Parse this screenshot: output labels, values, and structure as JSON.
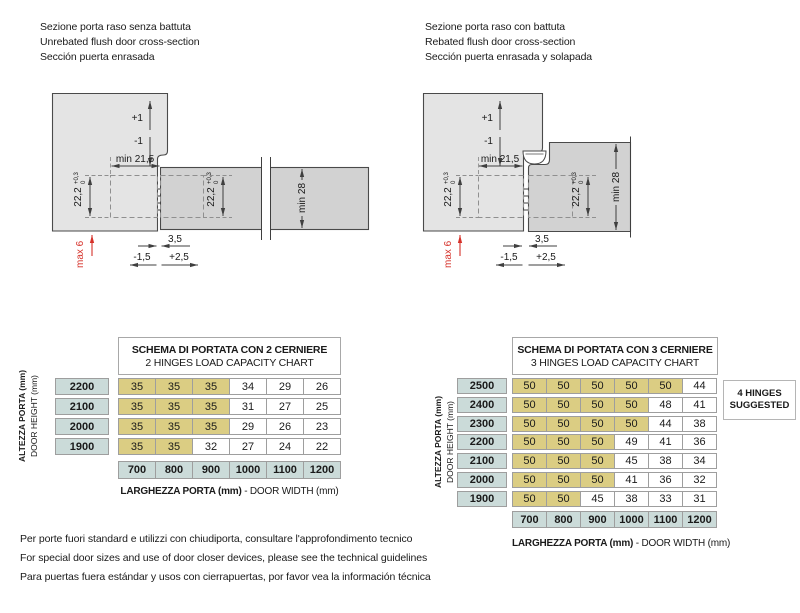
{
  "colors": {
    "highlight_yellow": "#dbcd83",
    "axis_teal": "#cbdbd9",
    "frame_gray": "#e4e4e4",
    "door_gray": "#d2d2d2",
    "accent_red": "#d63129"
  },
  "headers": {
    "left": {
      "lines": [
        "Sezione porta raso senza battuta",
        "Unrebated flush door cross-section",
        "Sección puerta enrasada"
      ]
    },
    "right": {
      "lines": [
        "Sezione porta raso con battuta",
        "Rebated flush door cross-section",
        "Sección puerta enrasada y solapada"
      ]
    }
  },
  "diagram_labels": {
    "adjust_up": "+1",
    "adjust_down": "-1",
    "min_reveal": "min 21,5",
    "hinge_cup": "22,2",
    "tol_plus": "+0,3",
    "tol_zero": "0",
    "min_door_thickness": "min 28",
    "gap": "3,5",
    "adjust_neg": "-1,5",
    "adjust_pos": "+2,5",
    "max_offset": "max 6"
  },
  "tables": {
    "left": {
      "title_line1": "SCHEMA DI PORTATA CON 2 CERNIERE",
      "title_line2": "2 HINGES LOAD CAPACITY CHART",
      "y_axis_bold": "ALTEZZA PORTA (mm)",
      "y_axis_regular": "DOOR HEIGHT (mm)",
      "x_axis_bold": "LARGHEZZA PORTA (mm)",
      "x_axis_regular": "- DOOR WIDTH (mm)",
      "columns": [
        "700",
        "800",
        "900",
        "1000",
        "1100",
        "1200"
      ],
      "rows": [
        {
          "height": "2200",
          "values": [
            "35",
            "35",
            "35",
            "34",
            "29",
            "26"
          ],
          "highlighted": 3
        },
        {
          "height": "2100",
          "values": [
            "35",
            "35",
            "35",
            "31",
            "27",
            "25"
          ],
          "highlighted": 3
        },
        {
          "height": "2000",
          "values": [
            "35",
            "35",
            "35",
            "29",
            "26",
            "23"
          ],
          "highlighted": 3
        },
        {
          "height": "1900",
          "values": [
            "35",
            "35",
            "32",
            "27",
            "24",
            "22"
          ],
          "highlighted": 2
        }
      ]
    },
    "right": {
      "title_line1": "SCHEMA DI PORTATA CON 3 CERNIERE",
      "title_line2": "3 HINGES LOAD CAPACITY CHART",
      "y_axis_bold": "ALTEZZA PORTA (mm)",
      "y_axis_regular": "DOOR HEIGHT (mm)",
      "x_axis_bold": "LARGHEZZA PORTA (mm)",
      "x_axis_regular": "- DOOR WIDTH (mm)",
      "columns": [
        "700",
        "800",
        "900",
        "1000",
        "1100",
        "1200"
      ],
      "rows": [
        {
          "height": "2500",
          "values": [
            "50",
            "50",
            "50",
            "50",
            "50",
            "44"
          ],
          "highlighted": 5
        },
        {
          "height": "2400",
          "values": [
            "50",
            "50",
            "50",
            "50",
            "48",
            "41"
          ],
          "highlighted": 4
        },
        {
          "height": "2300",
          "values": [
            "50",
            "50",
            "50",
            "50",
            "44",
            "38"
          ],
          "highlighted": 4
        },
        {
          "height": "2200",
          "values": [
            "50",
            "50",
            "50",
            "49",
            "41",
            "36"
          ],
          "highlighted": 3
        },
        {
          "height": "2100",
          "values": [
            "50",
            "50",
            "50",
            "45",
            "38",
            "34"
          ],
          "highlighted": 3
        },
        {
          "height": "2000",
          "values": [
            "50",
            "50",
            "50",
            "41",
            "36",
            "32"
          ],
          "highlighted": 3
        },
        {
          "height": "1900",
          "values": [
            "50",
            "50",
            "45",
            "38",
            "33",
            "31"
          ],
          "highlighted": 2
        }
      ],
      "note_line1": "4 HINGES",
      "note_line2": "SUGGESTED"
    }
  },
  "footnotes": {
    "lines": [
      "Per porte fuori standard e utilizzi con chiudiporta, consultare l'approfondimento tecnico",
      "For special door sizes and use of door closer devices, please see the technical guidelines",
      "Para puertas fuera estándar y usos con cierrapuertas, por favor vea la información técnica"
    ]
  }
}
